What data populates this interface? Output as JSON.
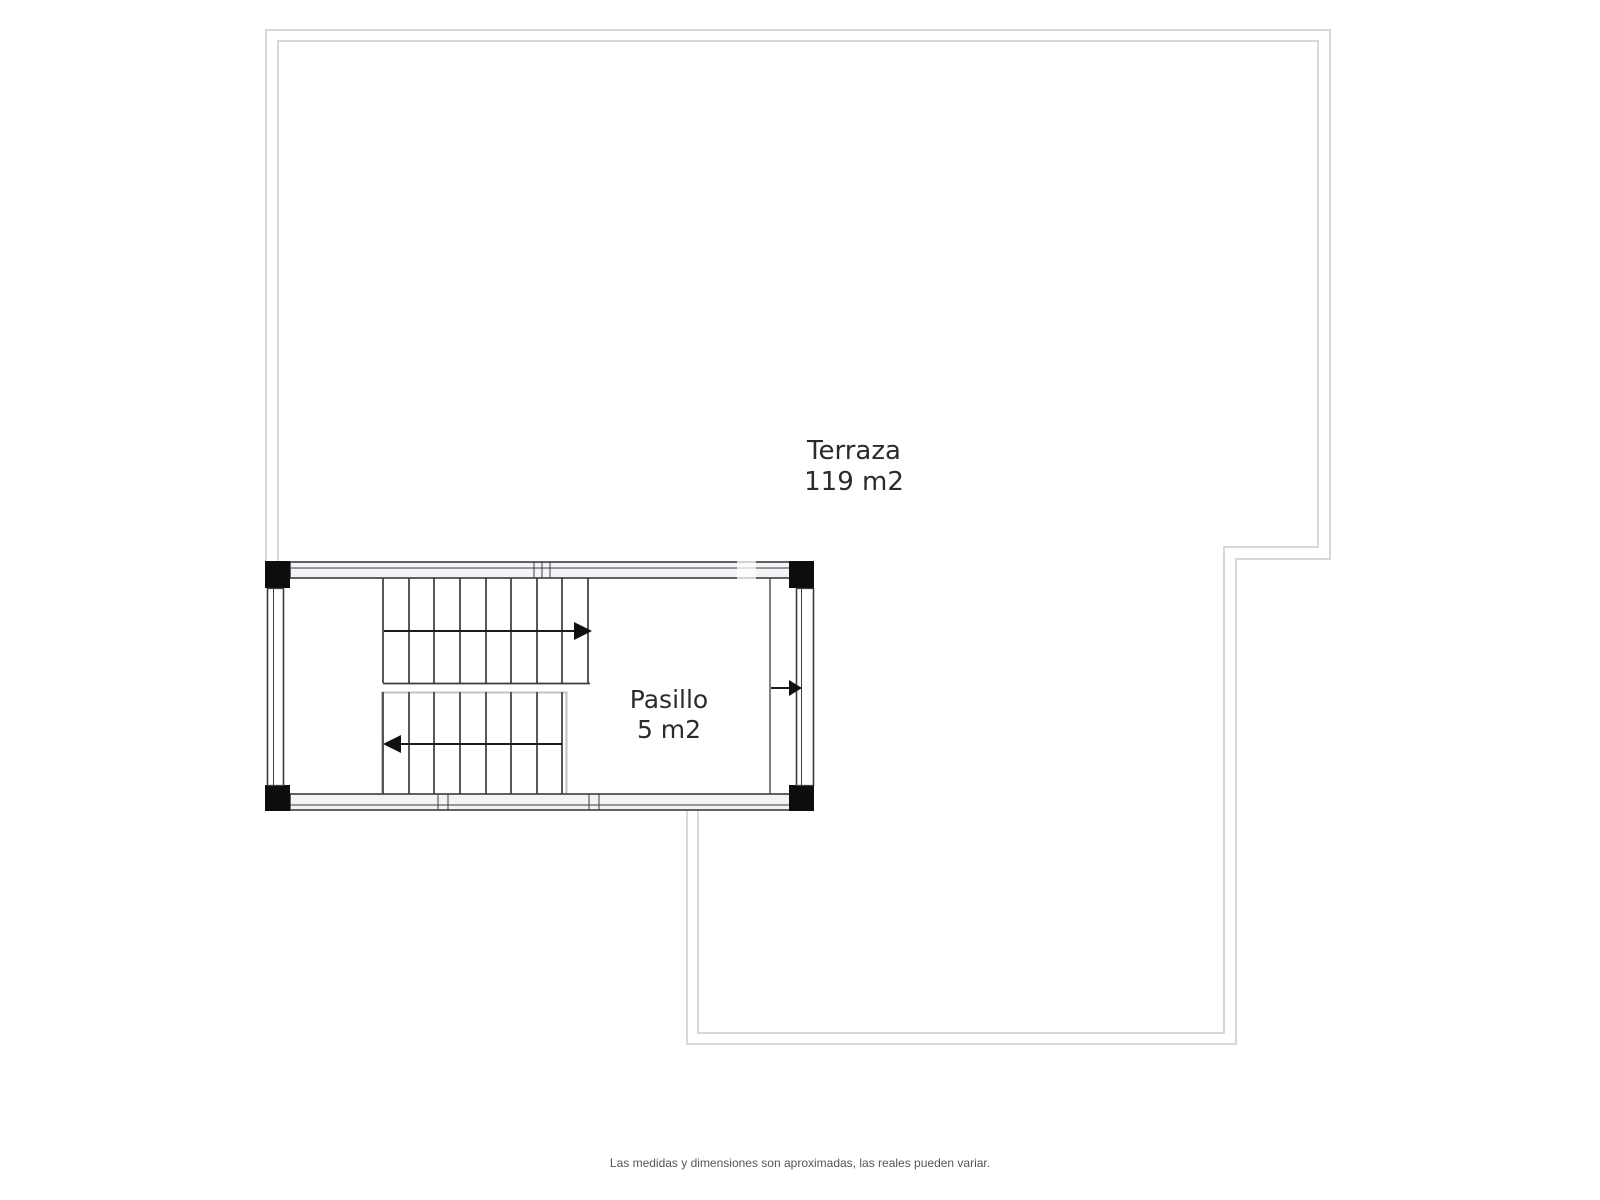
{
  "plan": {
    "rooms": [
      {
        "name": "Terraza",
        "area": "119 m2"
      },
      {
        "name": "Pasillo",
        "area": "5 m2"
      }
    ],
    "disclaimer": "Las medidas y dimensiones son aproximadas, las reales pueden variar."
  },
  "colors": {
    "outline": "#d8d8d8",
    "wall_line": "#3c3c3c",
    "wall_fill": "#f2f2f7",
    "corner_fill": "#0d0d0d",
    "stair_line": "#3b3b3b",
    "rail_line": "#c2c2c2",
    "label_text": "#2b2b2b",
    "disclaimer_text": "#555555",
    "page_bg": "#ffffff"
  }
}
